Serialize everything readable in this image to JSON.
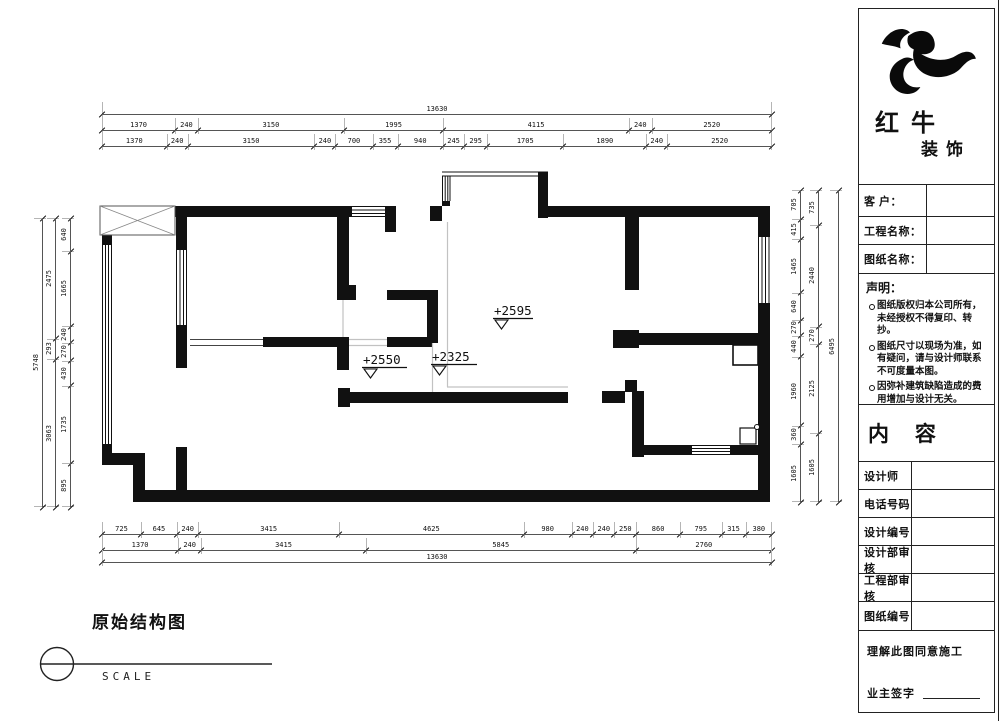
{
  "plan": {
    "levels": [
      "+2595",
      "+2550",
      "+2325"
    ],
    "ink": "#111111"
  },
  "dims": {
    "top": {
      "row1": [
        13630
      ],
      "row2": [
        1370,
        240,
        3150,
        1995,
        4115,
        240,
        2520
      ],
      "row3": [
        1370,
        240,
        3150,
        240,
        700,
        355,
        940,
        245,
        295,
        1705,
        1890,
        240,
        2520
      ]
    },
    "bottom": {
      "row1": [
        725,
        645,
        240,
        3415,
        4625,
        980,
        240,
        240,
        250,
        860,
        795,
        315,
        380
      ],
      "row2": [
        1370,
        240,
        3415,
        5845,
        2760
      ],
      "row3": [
        13630
      ]
    },
    "left": {
      "inner": [
        640,
        1665,
        240,
        270,
        430,
        1735,
        895
      ],
      "middle": [
        2475,
        293,
        3063
      ],
      "outer": [
        5748
      ]
    },
    "right": {
      "inner": [
        705,
        415,
        1465,
        640,
        270,
        440,
        1960,
        360,
        1605
      ],
      "middle": [
        735,
        2440,
        270,
        2125,
        1605
      ],
      "outer": [
        6495
      ]
    }
  },
  "footer": {
    "title": "原始结构图",
    "scale_label": "SCALE"
  },
  "panel": {
    "brand": {
      "name": "红牛",
      "suffix": "装饰"
    },
    "fields": [
      {
        "label": "客 户：",
        "value": ""
      },
      {
        "label": "工程名称：",
        "value": ""
      },
      {
        "label": "图纸名称：",
        "value": ""
      }
    ],
    "statement": {
      "heading": "声明：",
      "items": [
        "图纸版权归本公司所有，未经授权不得复印、转抄。",
        "图纸尺寸以现场为准，如有疑问，请与设计师联系不可度量本图。",
        "因弥补建筑缺陷造成的费用增加与设计无关。"
      ]
    },
    "content_heading": "内 容",
    "info_rows": [
      {
        "label": "设计师",
        "value": ""
      },
      {
        "label": "电话号码",
        "value": ""
      },
      {
        "label": "设计编号",
        "value": ""
      },
      {
        "label": "设计部审核",
        "value": ""
      },
      {
        "label": "工程部审核",
        "value": ""
      },
      {
        "label": "图纸编号",
        "value": ""
      }
    ],
    "signature": {
      "line1": "理解此图同意施工",
      "line2": "业主签字"
    }
  }
}
